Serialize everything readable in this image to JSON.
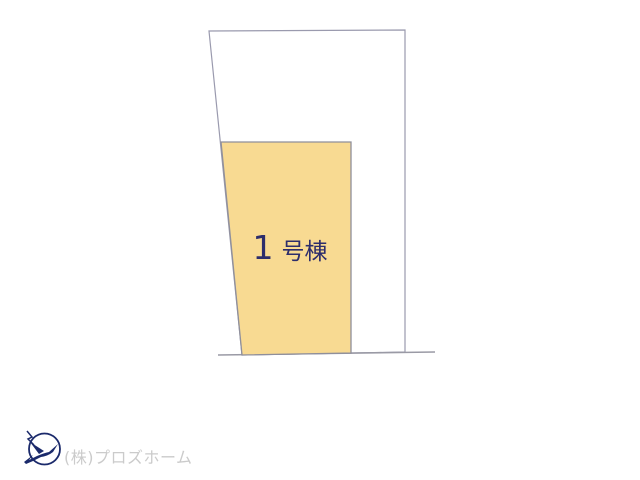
{
  "plan": {
    "parcel": {
      "points": "209,31 405,30 405,352 242,355",
      "fill": "#ffffff",
      "stroke": "#9a9aae"
    },
    "road_line": {
      "x1": "218",
      "y1": "355",
      "x2": "435",
      "y2": "352",
      "stroke": "#9a9aa5"
    },
    "building_lot": {
      "points": "221,142 351,142 351,353 242,355",
      "fill": "#f8da92",
      "stroke": "#8f8f9b",
      "label": "1号棟",
      "label_number": "1",
      "label_suffix": "号棟",
      "label_color": "#2d2d6b"
    }
  },
  "footer": {
    "company": "(株)プロズホーム",
    "company_color": "#cbcbcb",
    "logo_color": "#1b2a6b"
  }
}
